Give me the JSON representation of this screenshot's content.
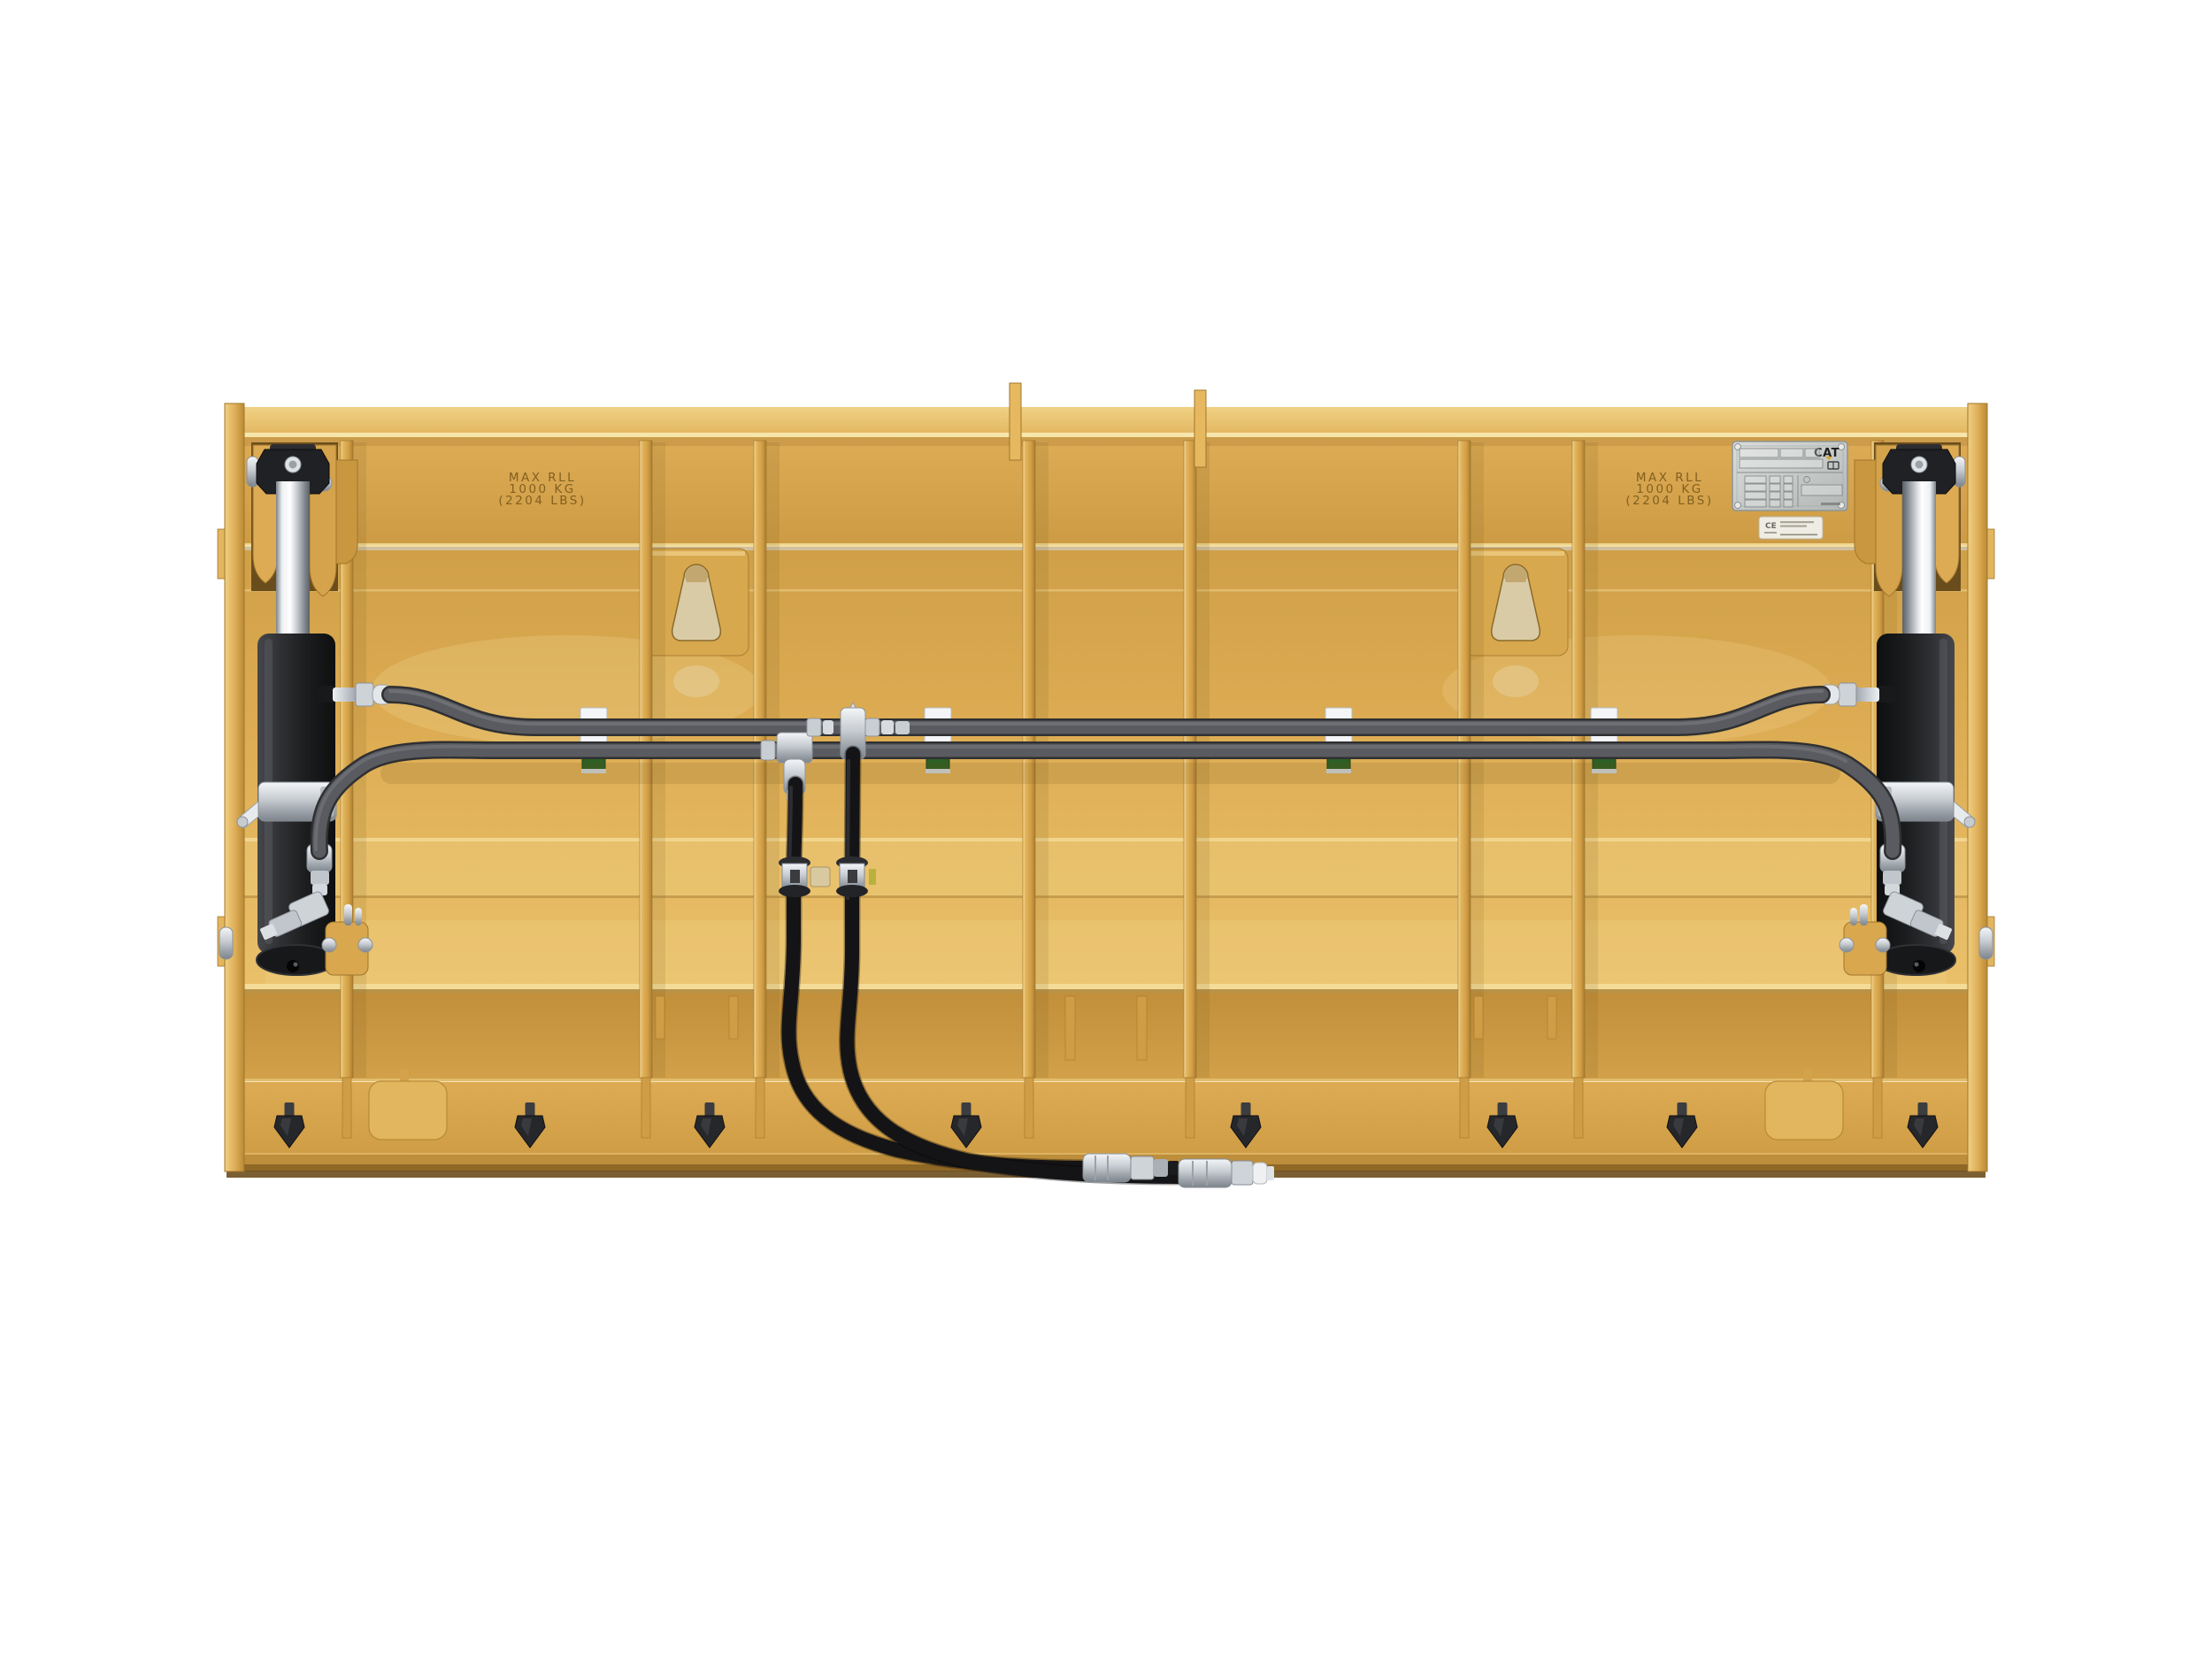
{
  "scene": {
    "background": "#ffffff"
  },
  "markings": {
    "stamp_left": {
      "line1": "MAX RLL",
      "line2": "1000 KG",
      "line3": "(2204 LBS)"
    },
    "stamp_right": {
      "line1": "MAX RLL",
      "line2": "1000 KG",
      "line3": "(2204 LBS)"
    },
    "serial_plate": {
      "brand": "CAT"
    },
    "ce_label": {
      "mark": "CE"
    }
  },
  "colors": {
    "body_yellow": "#e0b058",
    "body_yellow_dark": "#c9973f",
    "top_plate_yellow": "#eac873",
    "rib_highlight": "#f5dd97",
    "hose_gray": "#595b60",
    "hose_black": "#141416",
    "fitting_silver": "#d9dde1",
    "clamp_block_green": "#2d5f24",
    "clamp_block_white": "#f3f5f7",
    "cylinder_black": "#232427",
    "rod_chrome": "#e8ebee",
    "stamp_text": "#7b5a1d"
  }
}
